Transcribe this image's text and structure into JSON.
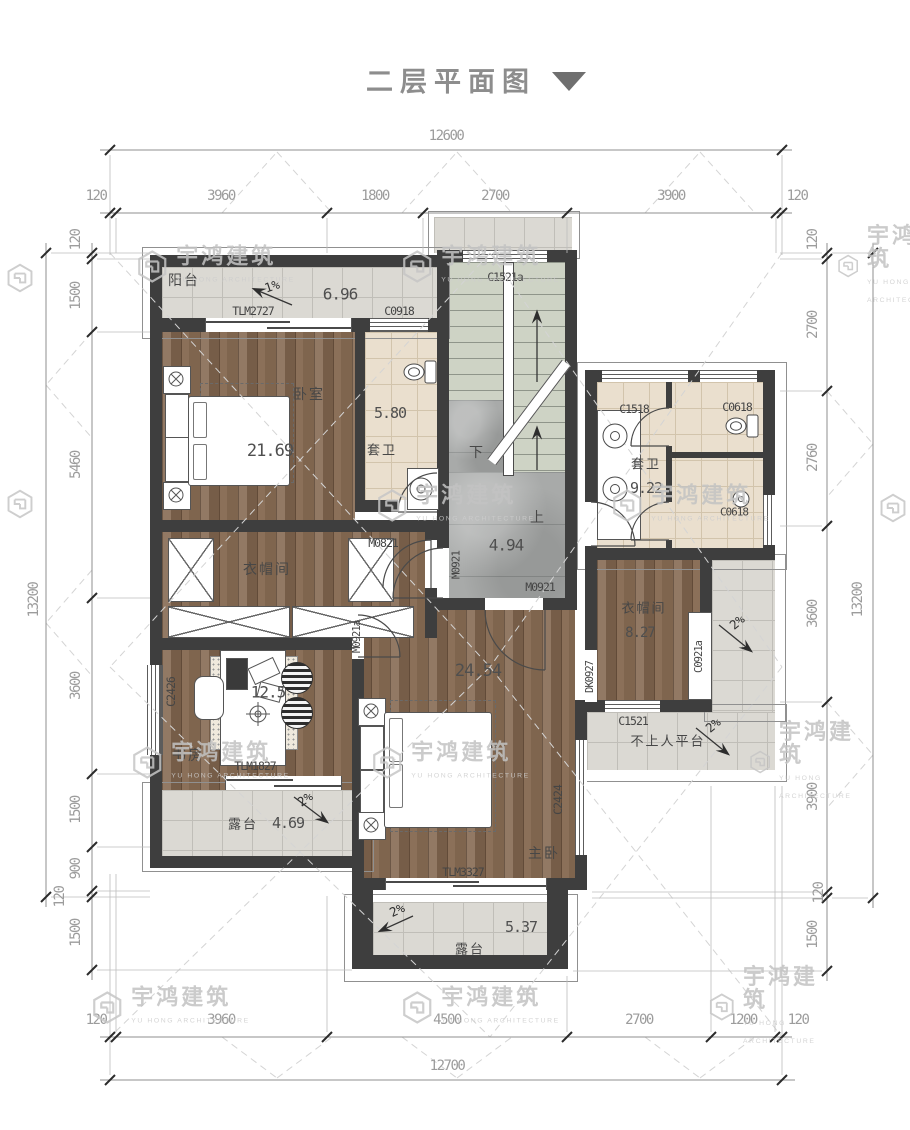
{
  "title": {
    "text": "二层平面图"
  },
  "watermark": {
    "cn": "宇鸿建筑",
    "en": "YU HONG ARCHITECTURE"
  },
  "dims": {
    "top_total": "12600",
    "bottom_total": "12700",
    "left_total": "13200",
    "right_total": "13200",
    "top": [
      "120",
      "3960",
      "1800",
      "2700",
      "3900",
      "120"
    ],
    "bottom": [
      "120",
      "3960",
      "4500",
      "2700",
      "1200",
      "120"
    ],
    "left": [
      "120",
      "1500",
      "5460",
      "3600",
      "1500",
      "900",
      "120",
      "1500"
    ],
    "right": [
      "120",
      "2700",
      "2760",
      "3600",
      "3900",
      "120",
      "1500"
    ]
  },
  "rooms": {
    "balcony": {
      "name": "阳台",
      "area": "6.96",
      "slope": "1%"
    },
    "bedroom": {
      "name": "卧室",
      "area": "21.69"
    },
    "ensuite": {
      "name": "套卫",
      "area": "5.80"
    },
    "stair": {
      "up": "上",
      "down": "下",
      "area": "4.94"
    },
    "bath": {
      "name": "套卫",
      "area": "9.22"
    },
    "closet_right": {
      "name": "衣帽间",
      "area": "8.27"
    },
    "closet_left": {
      "name": "衣帽间"
    },
    "study": {
      "name": "书房",
      "area": "12.5"
    },
    "terrace_left": {
      "name": "露台",
      "area": "4.69",
      "slope": "2%"
    },
    "terrace_bottom": {
      "name": "露台",
      "area": "5.37",
      "slope": "2%"
    },
    "platform": {
      "name": "不上人平台",
      "slope": "2%"
    },
    "master": {
      "name": "主卧",
      "area": "24.54"
    }
  },
  "codes": {
    "tlm2727": "TLM2727",
    "c0918": "C0918",
    "c1521a": "C1521a",
    "c1518": "C1518",
    "c0618": "C0618",
    "m0821": "M0821",
    "m0921": "M0921",
    "m0921a": "M0921a",
    "dk0927": "DK0927",
    "c0921a": "C0921a",
    "c1521": "C1521",
    "tlm1827": "TLM1827",
    "c2426": "C2426",
    "tlm3327": "TLM3327",
    "c2424": "C2424"
  }
}
